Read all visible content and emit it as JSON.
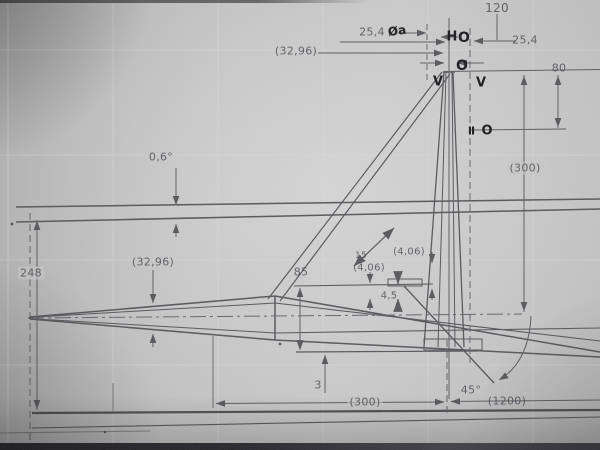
{
  "drawing": {
    "kind": "technical-drawing-photo",
    "colors": {
      "line": "#55555a",
      "thick_line": "#4c4c50",
      "dim_text": "#4d4d55",
      "ink_mark": "#17171b",
      "paper": "#c2c2c2"
    }
  },
  "dims": {
    "d120": "120",
    "d254_left": "25,4",
    "d254_right": "25,4",
    "d80": "80",
    "d3296_top": "(32,96)",
    "d300_right": "(300)",
    "d06deg": "0,6°",
    "d248": "248",
    "d3296_mid": "(32,96)",
    "d85": "85",
    "d15": "15",
    "d406_a": "(4,06)",
    "d406_b": "(4,06)",
    "d45": "4,5",
    "d3": "3",
    "d45deg": "45°",
    "d300_bottom": "(300)",
    "d1200": "(1200)"
  },
  "ink_marks": {
    "oa": "Øa",
    "h": "H",
    "ring1": "O",
    "ring2": "O",
    "v1": "V",
    "v2": "V",
    "bars": "II",
    "ring3": "O"
  }
}
